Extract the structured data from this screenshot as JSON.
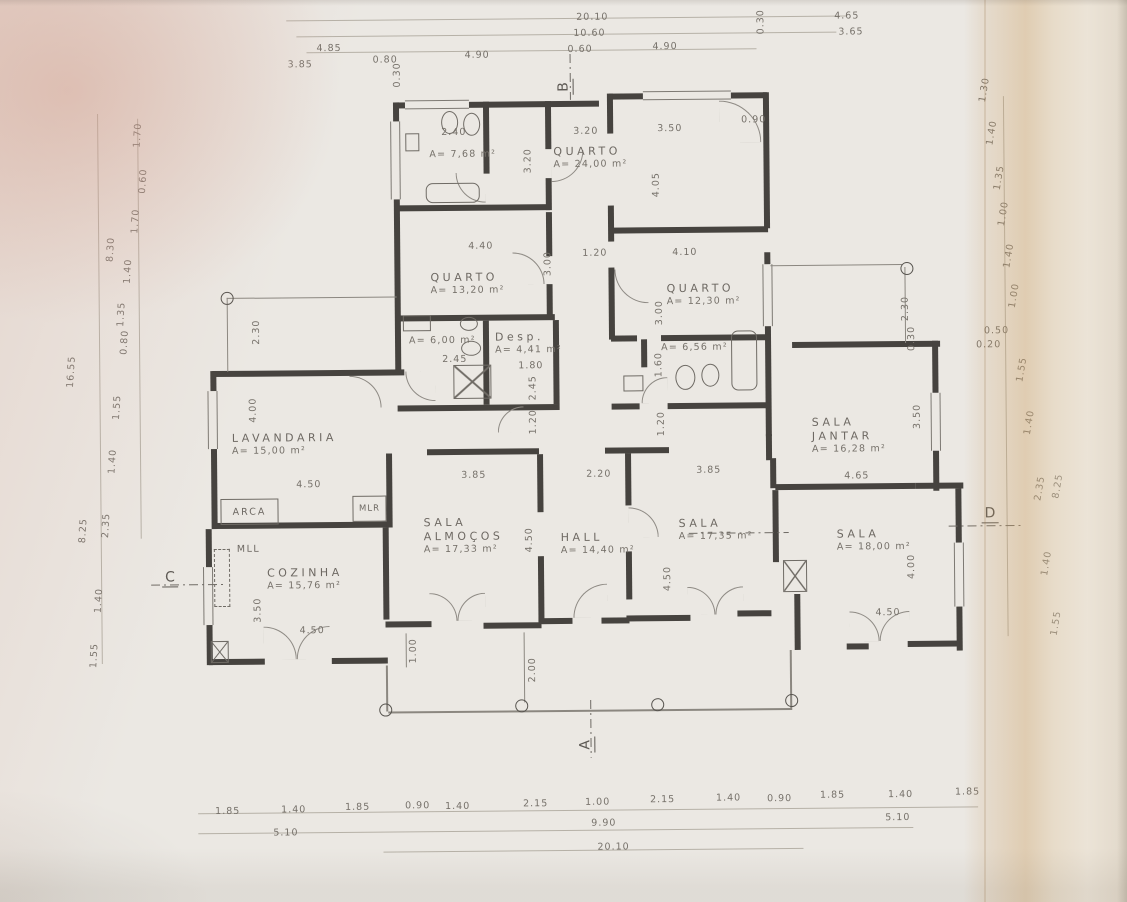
{
  "document": {
    "type": "scanned architectural floor plan",
    "language": "pt"
  },
  "rooms": [
    {
      "name": "QUARTO",
      "name2": "",
      "area": "A= 24,00 m²",
      "x": 556,
      "y": 145
    },
    {
      "name": "QUARTO",
      "name2": "",
      "area": "A= 13,20 m²",
      "x": 432,
      "y": 270
    },
    {
      "name": "QUARTO",
      "name2": "",
      "area": "A= 12,30 m²",
      "x": 668,
      "y": 283
    },
    {
      "name": "",
      "name2": "",
      "area": "A= 7,68 m²",
      "x": 432,
      "y": 148
    },
    {
      "name": "",
      "name2": "",
      "area": "A= 6,00 m²",
      "x": 410,
      "y": 334
    },
    {
      "name": "Desp.",
      "name2": "",
      "area": "A= 4,41 m²",
      "x": 496,
      "y": 330
    },
    {
      "name": "",
      "name2": "",
      "area": "A= 6,56 m²",
      "x": 662,
      "y": 343
    },
    {
      "name": "LAVANDARIA",
      "name2": "",
      "area": "A= 15,00 m²",
      "x": 232,
      "y": 429
    },
    {
      "name": "SALA",
      "name2": "ALMOÇOS",
      "area": "A= 17,33 m²",
      "x": 423,
      "y": 515
    },
    {
      "name": "HALL",
      "name2": "",
      "area": "A= 14,40 m²",
      "x": 560,
      "y": 531
    },
    {
      "name": "SALA",
      "name2": "",
      "area": "A= 17,35 m²",
      "x": 678,
      "y": 518
    },
    {
      "name": "SALA",
      "name2": "JANTAR",
      "area": "A= 16,28 m²",
      "x": 812,
      "y": 418
    },
    {
      "name": "SALA",
      "name2": "",
      "area": "A= 18,00 m²",
      "x": 836,
      "y": 530
    },
    {
      "name": "COZINHA",
      "name2": "",
      "area": "A= 15,76 m²",
      "x": 266,
      "y": 564
    }
  ],
  "fixed_labels": {
    "arca": "ARCA",
    "mlr": "MLR",
    "mll": "MLL"
  },
  "markers": [
    {
      "t": "B",
      "x": 560,
      "y": 78,
      "r": -90
    },
    {
      "t": "A",
      "x": 576,
      "y": 736,
      "r": -90
    },
    {
      "t": "C",
      "x": 161,
      "y": 566,
      "r": 0
    },
    {
      "t": "D",
      "x": 981,
      "y": 509,
      "r": 0
    }
  ],
  "dims": [
    {
      "t": "20.10",
      "x": 580,
      "y": 12
    },
    {
      "t": "10.60",
      "x": 577,
      "y": 28
    },
    {
      "t": "0.60",
      "x": 571,
      "y": 44
    },
    {
      "t": "4.90",
      "x": 656,
      "y": 42
    },
    {
      "t": "4.85",
      "x": 320,
      "y": 41
    },
    {
      "t": "3.85",
      "x": 291,
      "y": 57
    },
    {
      "t": "0.80",
      "x": 376,
      "y": 53
    },
    {
      "t": "0.30",
      "x": 388,
      "y": 68,
      "r": -90
    },
    {
      "t": "4.90",
      "x": 468,
      "y": 49
    },
    {
      "t": "0.30",
      "x": 752,
      "y": 18,
      "r": -90
    },
    {
      "t": "4.65",
      "x": 838,
      "y": 13
    },
    {
      "t": "3.65",
      "x": 842,
      "y": 29
    },
    {
      "t": "0.90",
      "x": 744,
      "y": 116
    },
    {
      "t": "3.50",
      "x": 660,
      "y": 124
    },
    {
      "t": "3.20",
      "x": 576,
      "y": 126
    },
    {
      "t": "2.40",
      "x": 444,
      "y": 126
    },
    {
      "t": "3.20",
      "x": 518,
      "y": 155,
      "r": -90
    },
    {
      "t": "4.05",
      "x": 646,
      "y": 180,
      "r": -90
    },
    {
      "t": "4.40",
      "x": 470,
      "y": 240
    },
    {
      "t": "1.20",
      "x": 584,
      "y": 248
    },
    {
      "t": "3.00",
      "x": 537,
      "y": 258,
      "r": -90
    },
    {
      "t": "4.10",
      "x": 674,
      "y": 248
    },
    {
      "t": "3.00",
      "x": 648,
      "y": 308,
      "r": -90
    },
    {
      "t": "2.45",
      "x": 443,
      "y": 353
    },
    {
      "t": "1.80",
      "x": 519,
      "y": 360
    },
    {
      "t": "2.45",
      "x": 521,
      "y": 382,
      "r": -90
    },
    {
      "t": "1.60",
      "x": 647,
      "y": 360,
      "r": -90
    },
    {
      "t": "2.30",
      "x": 894,
      "y": 306,
      "r": -90
    },
    {
      "t": "0.30",
      "x": 900,
      "y": 336,
      "r": -90
    },
    {
      "t": "0.50",
      "x": 985,
      "y": 329
    },
    {
      "t": "0.20",
      "x": 977,
      "y": 343
    },
    {
      "t": "2.30",
      "x": 245,
      "y": 324,
      "r": -90
    },
    {
      "t": "4.00",
      "x": 241,
      "y": 402,
      "r": -90
    },
    {
      "t": "1.20",
      "x": 521,
      "y": 416,
      "r": -90
    },
    {
      "t": "1.20",
      "x": 649,
      "y": 419,
      "r": -90
    },
    {
      "t": "4.50",
      "x": 296,
      "y": 477
    },
    {
      "t": "3.85",
      "x": 461,
      "y": 469
    },
    {
      "t": "2.20",
      "x": 586,
      "y": 469
    },
    {
      "t": "3.85",
      "x": 696,
      "y": 466
    },
    {
      "t": "4.65",
      "x": 844,
      "y": 473
    },
    {
      "t": "3.50",
      "x": 905,
      "y": 414,
      "r": -90
    },
    {
      "t": "4.50",
      "x": 516,
      "y": 534,
      "r": -90
    },
    {
      "t": "4.50",
      "x": 654,
      "y": 574,
      "r": -90
    },
    {
      "t": "4.00",
      "x": 898,
      "y": 564,
      "r": -90
    },
    {
      "t": "3.50",
      "x": 244,
      "y": 602,
      "r": -90
    },
    {
      "t": "4.50",
      "x": 298,
      "y": 623
    },
    {
      "t": "4.50",
      "x": 874,
      "y": 610
    },
    {
      "t": "1.00",
      "x": 399,
      "y": 644,
      "r": -90
    },
    {
      "t": "2.00",
      "x": 518,
      "y": 664,
      "r": -90
    },
    {
      "t": "1.70",
      "x": 128,
      "y": 126,
      "r": -86
    },
    {
      "t": "0.60",
      "x": 133,
      "y": 172,
      "r": -86
    },
    {
      "t": "1.70",
      "x": 125,
      "y": 212,
      "r": -86
    },
    {
      "t": "8.30",
      "x": 100,
      "y": 240,
      "r": -86
    },
    {
      "t": "1.40",
      "x": 117,
      "y": 262,
      "r": -86
    },
    {
      "t": "1.35",
      "x": 110,
      "y": 305,
      "r": -86
    },
    {
      "t": "0.80",
      "x": 113,
      "y": 333,
      "r": -86
    },
    {
      "t": "16.55",
      "x": 56,
      "y": 362,
      "r": -86
    },
    {
      "t": "1.55",
      "x": 105,
      "y": 398,
      "r": -86
    },
    {
      "t": "1.40",
      "x": 100,
      "y": 452,
      "r": -86
    },
    {
      "t": "2.35",
      "x": 93,
      "y": 516,
      "r": -86
    },
    {
      "t": "8.25",
      "x": 70,
      "y": 521,
      "r": -86
    },
    {
      "t": "1.40",
      "x": 85,
      "y": 591,
      "r": -86
    },
    {
      "t": "1.55",
      "x": 80,
      "y": 646,
      "r": -86
    },
    {
      "t": "1.30",
      "x": 975,
      "y": 88,
      "r": -80
    },
    {
      "t": "1.40",
      "x": 982,
      "y": 131,
      "r": -80
    },
    {
      "t": "1.35",
      "x": 989,
      "y": 176,
      "r": -80
    },
    {
      "t": "1.00",
      "x": 993,
      "y": 212,
      "r": -80
    },
    {
      "t": "1.40",
      "x": 998,
      "y": 254,
      "r": -80
    },
    {
      "t": "1.00",
      "x": 1003,
      "y": 294,
      "r": -80
    },
    {
      "t": "1.55",
      "x": 1010,
      "y": 368,
      "r": -80
    },
    {
      "t": "1.40",
      "x": 1017,
      "y": 421,
      "r": -80
    },
    {
      "t": "2.35",
      "x": 1027,
      "y": 487,
      "r": -80
    },
    {
      "t": "8.25",
      "x": 1045,
      "y": 485,
      "r": -80
    },
    {
      "t": "1.40",
      "x": 1033,
      "y": 562,
      "r": -80
    },
    {
      "t": "1.55",
      "x": 1042,
      "y": 622,
      "r": -80
    },
    {
      "t": "1.85",
      "x": 212,
      "y": 803
    },
    {
      "t": "1.40",
      "x": 278,
      "y": 802
    },
    {
      "t": "1.85",
      "x": 342,
      "y": 800
    },
    {
      "t": "0.90",
      "x": 402,
      "y": 799
    },
    {
      "t": "1.40",
      "x": 442,
      "y": 800
    },
    {
      "t": "2.15",
      "x": 520,
      "y": 798
    },
    {
      "t": "1.00",
      "x": 582,
      "y": 797
    },
    {
      "t": "2.15",
      "x": 647,
      "y": 795
    },
    {
      "t": "1.40",
      "x": 713,
      "y": 794
    },
    {
      "t": "0.90",
      "x": 764,
      "y": 795
    },
    {
      "t": "1.85",
      "x": 817,
      "y": 792
    },
    {
      "t": "1.40",
      "x": 885,
      "y": 792
    },
    {
      "t": "1.85",
      "x": 952,
      "y": 790
    },
    {
      "t": "5.10",
      "x": 270,
      "y": 825
    },
    {
      "t": "9.90",
      "x": 588,
      "y": 818
    },
    {
      "t": "5.10",
      "x": 882,
      "y": 815
    },
    {
      "t": "20.10",
      "x": 594,
      "y": 842
    }
  ]
}
